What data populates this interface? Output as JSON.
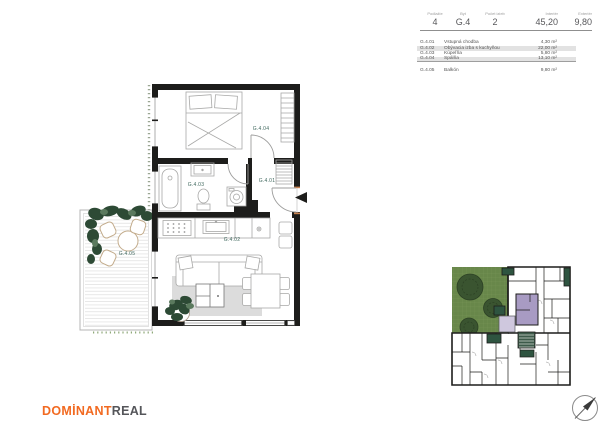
{
  "header": {
    "cells": [
      {
        "label": "Podlažie",
        "value": "4"
      },
      {
        "label": "Byt",
        "value": "G.4"
      },
      {
        "label": "Počet izieb",
        "value": "2"
      },
      {
        "label": "Interiér",
        "value": "45,20"
      },
      {
        "label": "Exteriér",
        "value": "9,80"
      }
    ]
  },
  "legend": {
    "interior": [
      {
        "code": "G.4.01",
        "name": "Vstupná chodba",
        "area": "4,30 m²"
      },
      {
        "code": "G.4.02",
        "name": "Obývacia izba s kuchyňou",
        "area": "22,00 m²"
      },
      {
        "code": "G.4.03",
        "name": "Kúpeľňa",
        "area": "5,80 m²"
      },
      {
        "code": "G.4.04",
        "name": "Spálňa",
        "area": "13,10 m²"
      }
    ],
    "exterior": [
      {
        "code": "G.4.05",
        "name": "Balkón",
        "area": "9,80 m²"
      }
    ]
  },
  "plan_labels": {
    "hall": "G.4.01",
    "living": "G.4.02",
    "bathroom": "G.4.03",
    "bedroom": "G.4.04",
    "balcony": "G.4.05"
  },
  "branding": {
    "primary": "DOMİNANT",
    "secondary": "REAL"
  },
  "colors": {
    "accent_orange": "#f26a21",
    "logo_gray": "#55565a",
    "wall": "#1d1d1b",
    "room_label": "#41695f",
    "lawn_green": "#68874a",
    "tree_green": "#3a5430",
    "unit_highlight": "#a89bc3",
    "unit_highlight_light": "#cfc8de",
    "balcony_green": "#2e5440",
    "row_highlight": "#e2e2e2"
  }
}
